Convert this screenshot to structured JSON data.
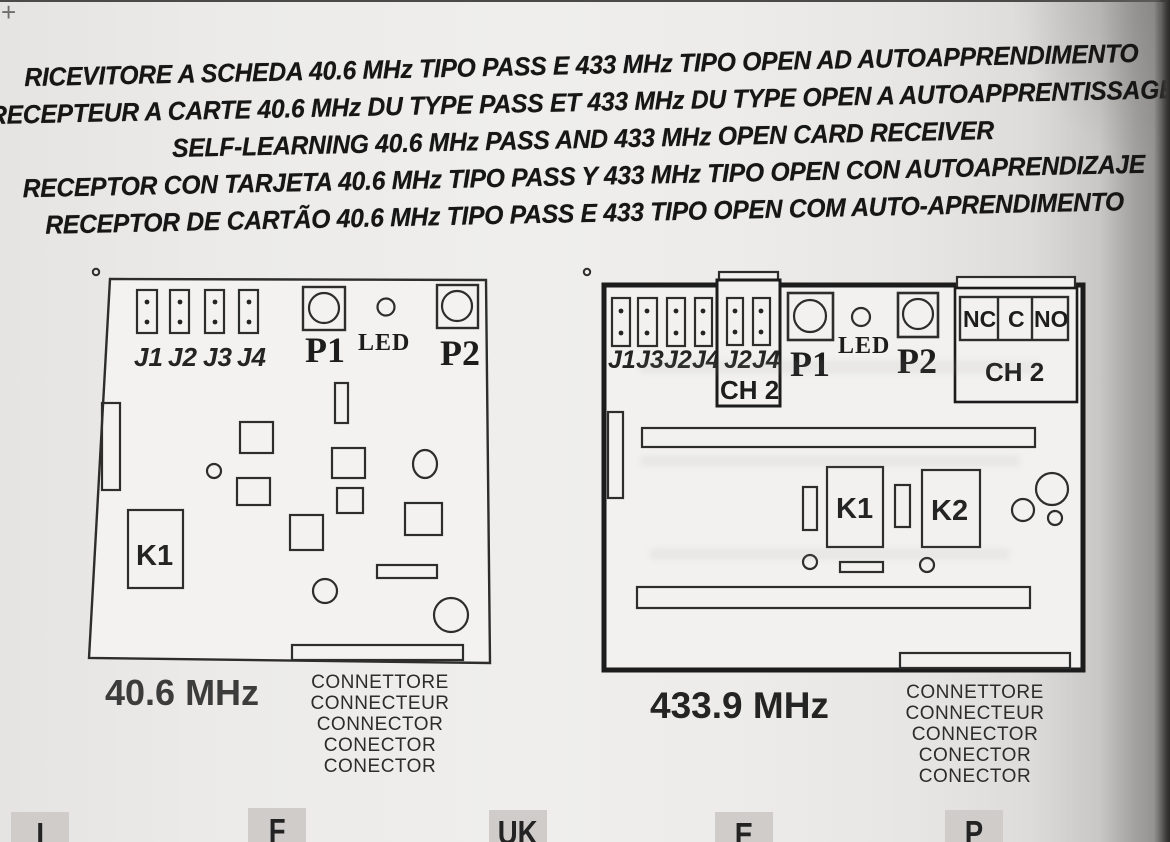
{
  "colors": {
    "paper": "#ecebe9",
    "ink": "#1a1a1a",
    "board_fill": "#f3f2f0",
    "stroke": "#2d2d2d",
    "tab_gray": "#cfccc9",
    "scan_edge_dark": "#2b2927"
  },
  "crop_mark": "+",
  "titles": {
    "line_it": "RICEVITORE A SCHEDA 40.6 MHz TIPO PASS E 433 MHz TIPO OPEN AD AUTOAPPRENDIMENTO",
    "line_fr": "RECEPTEUR A CARTE 40.6 MHz DU TYPE PASS ET 433 MHz DU TYPE OPEN A AUTOAPPRENTISSAGE",
    "line_en": "SELF-LEARNING 40.6 MHz PASS AND 433 MHz OPEN CARD RECEIVER",
    "line_es": "RECEPTOR CON TARJETA 40.6 MHz TIPO PASS Y 433 MHz TIPO OPEN CON AUTOAPRENDIZAJE",
    "line_pt": "RECEPTOR DE CARTÃO 40.6 MHz TIPO PASS E 433 TIPO OPEN COM AUTO-APRENDIMENTO"
  },
  "board_left": {
    "frequency": "40.6 MHz",
    "jumpers": [
      "J1",
      "J2",
      "J3",
      "J4"
    ],
    "button1": "P1",
    "led": "LED",
    "button2": "P2",
    "relay1": "K1",
    "connector_labels": [
      "CONNETTORE",
      "CONNECTEUR",
      "CONNECTOR",
      "CONECTOR",
      "CONECTOR"
    ]
  },
  "board_right": {
    "frequency": "433.9 MHz",
    "jumpers": [
      "J1",
      "J3",
      "J2",
      "J4"
    ],
    "ch2_box": {
      "jumpers": [
        "J2",
        "J4"
      ],
      "label": "CH 2"
    },
    "button1": "P1",
    "led": "LED",
    "button2": "P2",
    "terminal": {
      "cells": [
        "NC",
        "C",
        "NO"
      ],
      "label": "CH 2"
    },
    "relay1": "K1",
    "relay2": "K2",
    "connector_labels": [
      "CONNETTORE",
      "CONNECTEUR",
      "CONNECTOR",
      "CONECTOR",
      "CONECTOR"
    ]
  },
  "language_tabs": [
    "I",
    "F",
    "UK",
    "E",
    "P"
  ]
}
